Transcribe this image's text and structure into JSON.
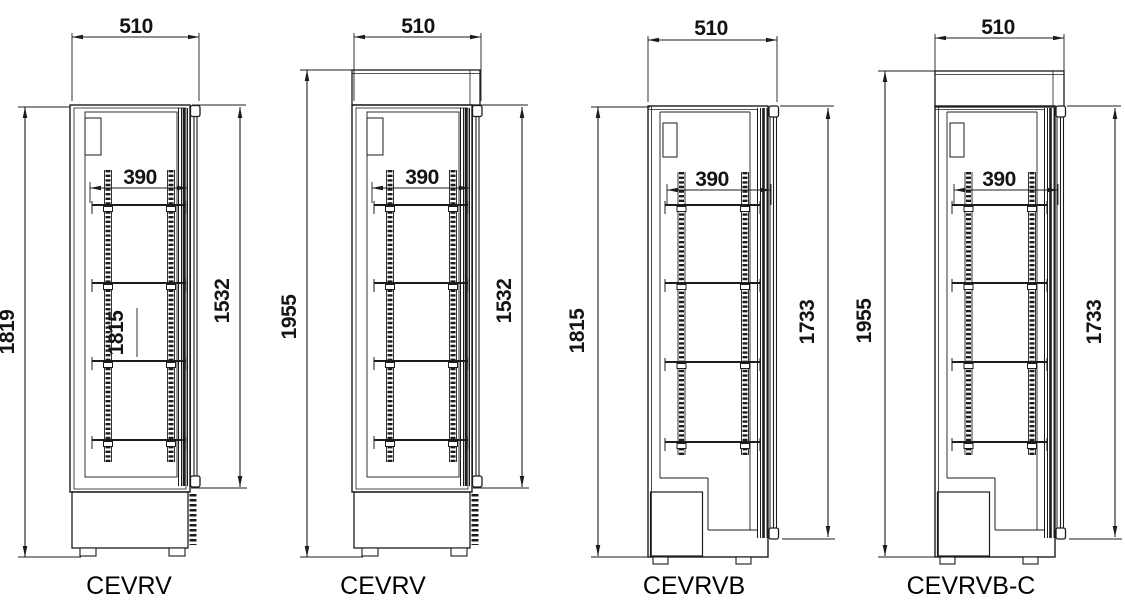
{
  "drawing": {
    "background": "#ffffff",
    "line_color": "#1c1c1c",
    "text_color": "#141414"
  },
  "figures": [
    {
      "label": "CEVRV",
      "width_mm": "510",
      "shelf_width_mm": "390",
      "overall_height_mm": "1819",
      "door_height_mm": "1532",
      "interior_height_mm": "1815"
    },
    {
      "label": "CEVRV",
      "width_mm": "510",
      "shelf_width_mm": "390",
      "overall_height_mm": "1955",
      "door_height_mm": "1532"
    },
    {
      "label": "CEVRVB",
      "width_mm": "510",
      "shelf_width_mm": "390",
      "overall_height_mm": "1815",
      "door_height_mm": "1733"
    },
    {
      "label": "CEVRVB-C",
      "width_mm": "510",
      "shelf_width_mm": "390",
      "overall_height_mm": "1955",
      "door_height_mm": "1733"
    }
  ]
}
